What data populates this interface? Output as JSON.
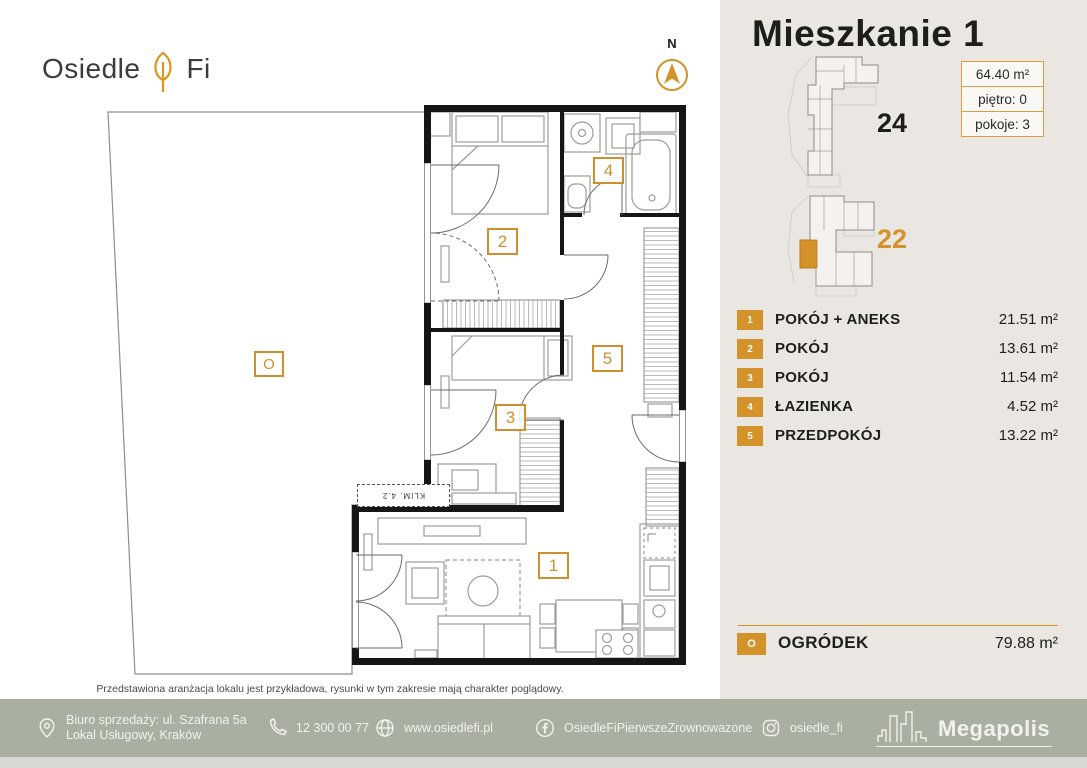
{
  "brand": {
    "word1": "Osiedle",
    "word2": "Fi"
  },
  "compass": {
    "north": "N"
  },
  "panel": {
    "title": "Mieszkanie 1",
    "buildings": [
      {
        "number": "24"
      },
      {
        "number": "22"
      }
    ],
    "info": [
      {
        "value": "64.40 m²"
      },
      {
        "value": "piętro: 0"
      },
      {
        "value": "pokoje: 3"
      }
    ],
    "rooms": [
      {
        "num": "1",
        "name": "POKÓJ + ANEKS",
        "area": "21.51 m²"
      },
      {
        "num": "2",
        "name": "POKÓJ",
        "area": "13.61 m²"
      },
      {
        "num": "3",
        "name": "POKÓJ",
        "area": "11.54 m²"
      },
      {
        "num": "4",
        "name": "ŁAZIENKA",
        "area": "4.52 m²"
      },
      {
        "num": "5",
        "name": "PRZEDPOKÓJ",
        "area": "13.22 m²"
      }
    ],
    "garden": {
      "num": "O",
      "name": "OGRÓDEK",
      "area": "79.88 m²"
    }
  },
  "plan": {
    "labels": {
      "l1": "1",
      "l2": "2",
      "l3": "3",
      "l4": "4",
      "l5": "5",
      "lo": "O"
    },
    "klim": "KLIM. 4.2",
    "disclaimer": "Przedstawiona aranżacja lokalu jest przykładowa, rysunki w tym zakresie mają charakter poglądowy."
  },
  "footer": {
    "address_line1": "Biuro sprzedaży: ul. Szafrana 5a",
    "address_line2": "Lokal Usługowy, Kraków",
    "phone": "12 300 00 77",
    "website": "www.osiedlefi.pl",
    "facebook": "OsiedleFiPierwszeZrownowazone",
    "instagram": "osiedle_fi",
    "partner": "Megapolis"
  },
  "colors": {
    "accent": "#d4922a",
    "panel_bg": "#eae6e2",
    "footer_bg": "#a9b0a2"
  }
}
